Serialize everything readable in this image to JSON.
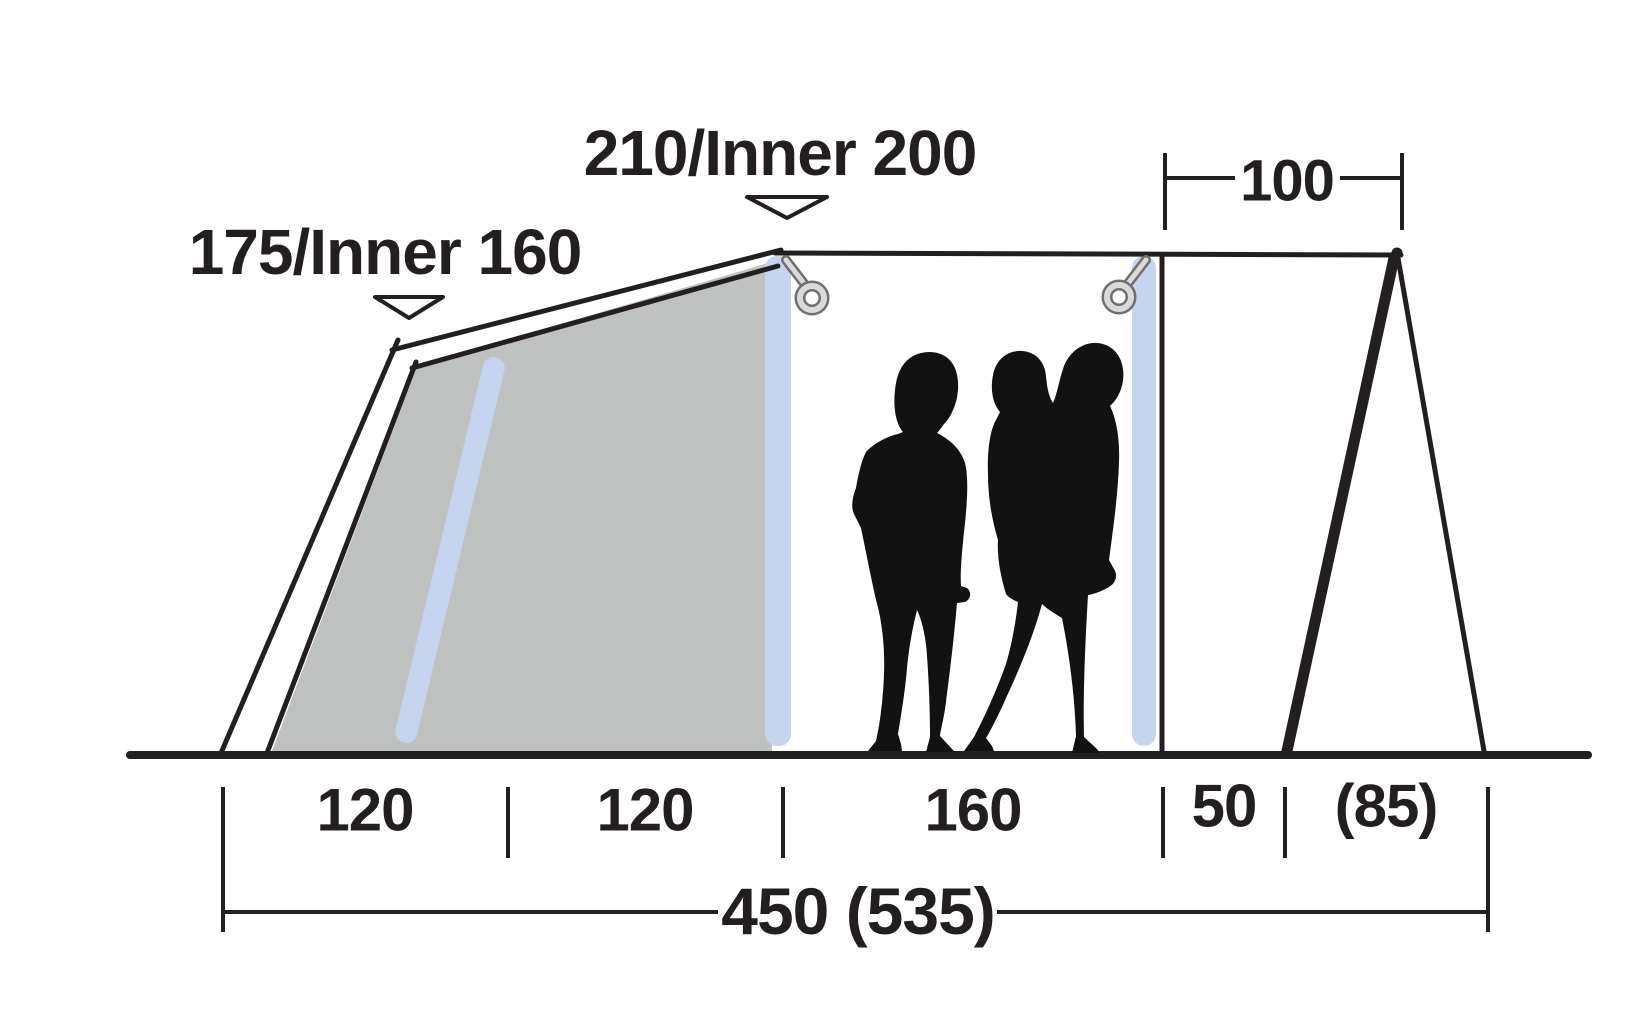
{
  "diagram": {
    "type": "tent-side-profile-dimension-diagram",
    "labels": {
      "peak_height": "210/Inner 200",
      "rear_height": "175/Inner 160"
    },
    "dimensions": {
      "canopy_depth": "100",
      "floor_sections": [
        "120",
        "120",
        "160",
        "50",
        "(85)"
      ],
      "total_length": "450 (535)"
    },
    "colors": {
      "line": "#231f20",
      "canvas_gray": "#bfc1c0",
      "pole_blue": "#c7d4ee",
      "ring_light": "#d9dad9",
      "ring_dark": "#6e6f6e",
      "silhouette": "#121212",
      "background": "#ffffff"
    }
  }
}
